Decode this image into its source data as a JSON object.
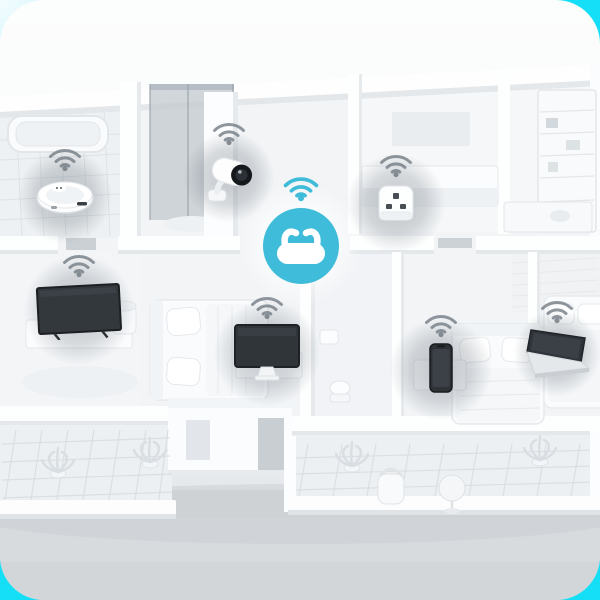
{
  "scene": {
    "type": "3d-isometric-smart-home-floorplan",
    "description": "White 3D rendered apartment floor plan seen from above; a teal Wi-Fi hub in the central hallway wirelessly connects smart devices around the home, each marked with a grey Wi-Fi signal icon and a soft round shadow",
    "colors": {
      "backdrop_cyan": "#14dff6",
      "backdrop_pale_corner": "#f4fcfe",
      "card_top": "#fcfdfd",
      "card_bottom": "#d6d9dc",
      "floor": "#f2f4f6",
      "wall": "#fdfefe",
      "wall_shadow": "#e4e8eb",
      "shower_glass": "#c6ccd1",
      "device_screen": "#30353a",
      "accent_teal": "#3ebcd9",
      "wifi_grey": "#747d85"
    }
  },
  "hub": {
    "label": "Wi-Fi router hub",
    "icon": "wifi-router-icon",
    "signal_icon": "wifi-signal-icon",
    "signal_color": "#3ebcd9"
  },
  "devices": [
    {
      "id": "robot-vacuum",
      "label": "Robot vacuum",
      "icon": "robot-vacuum-icon",
      "signal_icon": "wifi-signal-icon"
    },
    {
      "id": "security-camera",
      "label": "Security camera",
      "icon": "security-camera-icon",
      "signal_icon": "wifi-signal-icon"
    },
    {
      "id": "smart-plug",
      "label": "Smart plug",
      "icon": "smart-plug-icon",
      "signal_icon": "wifi-signal-icon"
    },
    {
      "id": "television",
      "label": "Television",
      "icon": "tv-icon",
      "signal_icon": "wifi-signal-icon"
    },
    {
      "id": "monitor",
      "label": "Desktop monitor",
      "icon": "monitor-icon",
      "signal_icon": "wifi-signal-icon"
    },
    {
      "id": "smartphone",
      "label": "Smartphone",
      "icon": "smartphone-icon",
      "signal_icon": "wifi-signal-icon"
    },
    {
      "id": "laptop",
      "label": "Laptop",
      "icon": "laptop-icon",
      "signal_icon": "wifi-signal-icon"
    }
  ],
  "rooms": [
    "bathroom",
    "shower room",
    "central hallway",
    "living room",
    "kitchen",
    "bedroom left",
    "bedroom right",
    "small bathroom",
    "balcony left",
    "terrace"
  ]
}
